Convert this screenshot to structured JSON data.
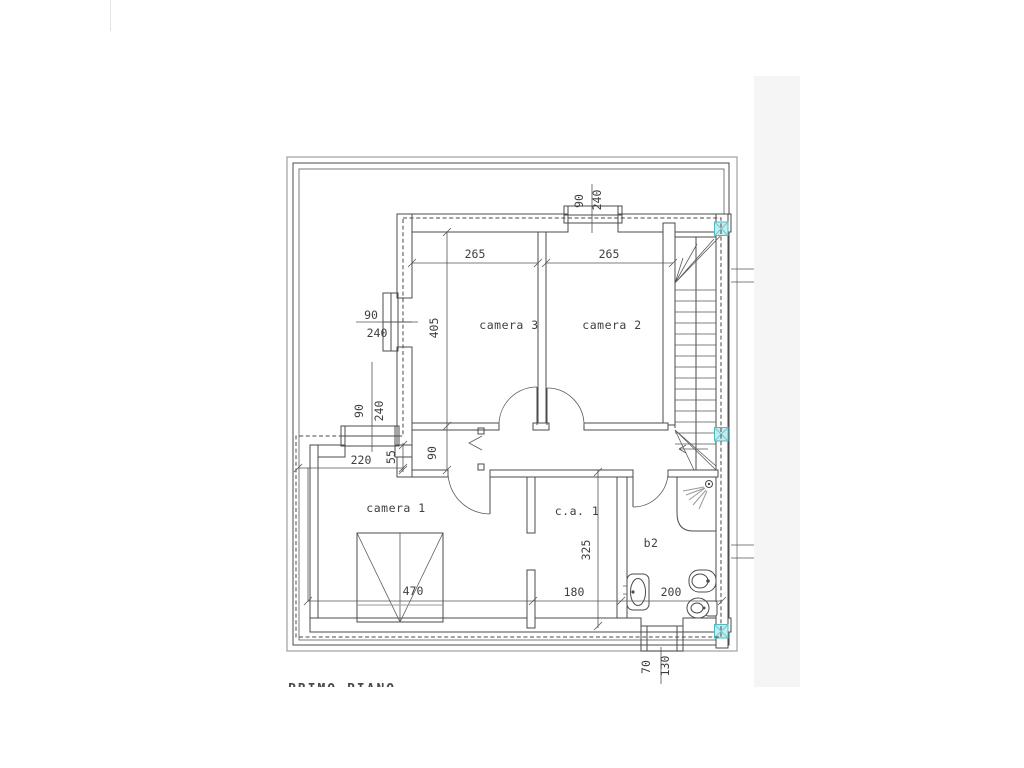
{
  "page": {
    "floor_label": "PRIMO PIANO"
  },
  "rooms": [
    {
      "id": "camera3",
      "label": "camera 3"
    },
    {
      "id": "camera2",
      "label": "camera 2"
    },
    {
      "id": "camera1",
      "label": "camera 1"
    },
    {
      "id": "closet",
      "label": "c.a. 1"
    },
    {
      "id": "bath",
      "label": "b2"
    }
  ],
  "dimensions": {
    "camera3_width": "265",
    "camera2_width": "265",
    "camera3_depth": "405",
    "hallway_width": "90",
    "wall_offset": "55",
    "terrace_left": "220",
    "camera1_width": "470",
    "closet_width": "180",
    "bath_width": "200",
    "closet_depth": "325",
    "window_left": {
      "w": "90",
      "h": "240"
    },
    "window_camera1": {
      "w": "90",
      "h": "240"
    },
    "window_top": {
      "w": "90",
      "h": "240"
    },
    "window_bath": {
      "w": "70",
      "h": "130"
    }
  },
  "colors": {
    "line": "#4b4b4b",
    "column_fill": "#c3ecee",
    "column_stroke": "#4fb9c0",
    "scan_band": "#f5f5f6"
  }
}
